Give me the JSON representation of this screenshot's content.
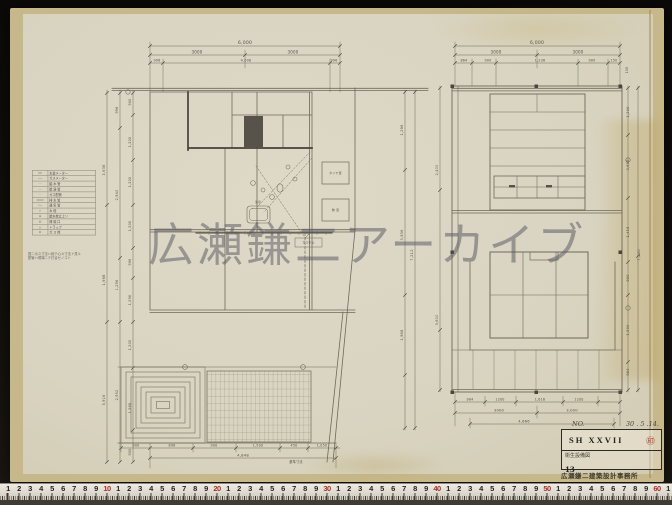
{
  "palette": {
    "backdrop": "#0e0d0a",
    "paper": "#d9d4c1",
    "paper_edge": "#c6b88a",
    "ink": "#6e6959",
    "ink_bold": "#45423a",
    "stamp_red": "#ae3226",
    "ruler_red": "#a93028",
    "watermark_gray": "#58585f"
  },
  "watermark": {
    "text": "広瀬鎌二アーカイブ"
  },
  "legend": {
    "rows": [
      {
        "sym": "━━",
        "label": "水道メーター"
      },
      {
        "sym": "──",
        "label": "ガスメーター"
      },
      {
        "sym": "‐ ‐",
        "label": "給 水 管"
      },
      {
        "sym": "-·-",
        "label": "給 湯 管"
      },
      {
        "sym": "····",
        "label": "ガス配管"
      },
      {
        "sym": "═══",
        "label": "排 水 管"
      },
      {
        "sym": "○─",
        "label": "通 気 管"
      },
      {
        "sym": "◇",
        "label": "水  栓"
      },
      {
        "sym": "●",
        "label": "給水栓立上リ"
      },
      {
        "sym": "◎",
        "label": "掃 除 口"
      },
      {
        "sym": "△",
        "label": "トラップ"
      },
      {
        "sym": "⊙",
        "label": "ガ ス 栓"
      }
    ]
  },
  "note": {
    "line1": "図ニ示ス寸法ハ総テ心々寸法ト見ル",
    "line2": "配管ハ現場ニテ打合セノコト"
  },
  "title_block": {
    "no_label": "NO.",
    "date": "30 . 5 .14.",
    "code": "SH XXVII",
    "stamp": "㊞",
    "subtitle": "衛生設備図",
    "sheet_no": "13",
    "office": "広瀬鎌二建築設計事務所"
  },
  "ruler": {
    "start_x": 8,
    "step": 11,
    "labels": [
      "1",
      "2",
      "3",
      "4",
      "5",
      "6",
      "7",
      "8",
      "9",
      "10",
      "1",
      "2",
      "3",
      "4",
      "5",
      "6",
      "7",
      "8",
      "9",
      "20",
      "1",
      "2",
      "3",
      "4",
      "5",
      "6",
      "7",
      "8",
      "9",
      "30",
      "1",
      "2",
      "3",
      "4",
      "5",
      "6",
      "7",
      "8",
      "9",
      "40",
      "1",
      "2",
      "3",
      "4",
      "5",
      "6",
      "7",
      "8",
      "9",
      "50",
      "1",
      "2",
      "3",
      "4",
      "5",
      "6",
      "7",
      "8",
      "9",
      "60",
      "1"
    ]
  },
  "drawing_labels": [
    {
      "t": "6,000",
      "x": 245,
      "y": 44
    },
    {
      "t": "3000",
      "x": 197,
      "y": 53.5,
      "s": 4
    },
    {
      "t": "3000",
      "x": 293,
      "y": 53.5,
      "s": 4
    },
    {
      "t": "996",
      "x": 157,
      "y": 61.5,
      "s": 3.4
    },
    {
      "t": "4,008",
      "x": 246,
      "y": 61.5,
      "s": 3.4
    },
    {
      "t": "996",
      "x": 334,
      "y": 61.5,
      "s": 3.4
    },
    {
      "t": "3,936",
      "x": 105,
      "y": 170,
      "r": -90,
      "s": 3.6
    },
    {
      "t": "1,968",
      "x": 105,
      "y": 280,
      "r": -90,
      "s": 3.6
    },
    {
      "t": "5,916",
      "x": 105,
      "y": 400,
      "r": -90,
      "s": 3.4
    },
    {
      "t": "996",
      "x": 118,
      "y": 110,
      "r": -90,
      "s": 3.4
    },
    {
      "t": "2,940",
      "x": 118,
      "y": 195,
      "r": -90,
      "s": 3.4
    },
    {
      "t": "1,296",
      "x": 118,
      "y": 285,
      "r": -90,
      "s": 3.4
    },
    {
      "t": "2,952",
      "x": 118,
      "y": 395,
      "r": -90,
      "s": 3.4
    },
    {
      "t": "900",
      "x": 131,
      "y": 102,
      "r": -90,
      "s": 3.3
    },
    {
      "t": "1,200",
      "x": 131,
      "y": 142,
      "r": -90,
      "s": 3.3
    },
    {
      "t": "1,200",
      "x": 131,
      "y": 182,
      "r": -90,
      "s": 3.3
    },
    {
      "t": "1,500",
      "x": 131,
      "y": 226,
      "r": -90,
      "s": 3.3
    },
    {
      "t": "996",
      "x": 131,
      "y": 262,
      "r": -90,
      "s": 3.3
    },
    {
      "t": "1,296",
      "x": 131,
      "y": 300,
      "r": -90,
      "s": 3.3
    },
    {
      "t": "1,200",
      "x": 131,
      "y": 345,
      "r": -90,
      "s": 3.3
    },
    {
      "t": "1,968",
      "x": 131,
      "y": 408,
      "r": -90,
      "s": 3.3
    },
    {
      "t": "900",
      "x": 131,
      "y": 452,
      "r": -90,
      "s": 3.3
    },
    {
      "t": "900",
      "x": 136,
      "y": 446.5,
      "s": 3.3
    },
    {
      "t": "898",
      "x": 172,
      "y": 446.5,
      "s": 3.3
    },
    {
      "t": "900",
      "x": 214,
      "y": 446.5,
      "s": 3.3
    },
    {
      "t": "1,500",
      "x": 258,
      "y": 446.5,
      "s": 3.3
    },
    {
      "t": "450",
      "x": 294,
      "y": 446.5,
      "s": 3.3
    },
    {
      "t": "1,050",
      "x": 322,
      "y": 446.5,
      "s": 3.3
    },
    {
      "t": "4,848",
      "x": 243,
      "y": 456.5,
      "s": 3.8
    },
    {
      "t": "基準寸法",
      "x": 296,
      "y": 463,
      "s": 3.2
    },
    {
      "t": "1,296",
      "x": 403,
      "y": 130,
      "r": -90,
      "s": 3.5
    },
    {
      "t": "3,936",
      "x": 403,
      "y": 235,
      "r": -90,
      "s": 3.5
    },
    {
      "t": "1,968",
      "x": 403,
      "y": 335,
      "r": -90,
      "s": 3.5
    },
    {
      "t": "7,212",
      "x": 413,
      "y": 255,
      "r": -90,
      "s": 3.7
    },
    {
      "t": "タイヤ置",
      "x": 335.5,
      "y": 174,
      "s": 3
    },
    {
      "t": "物 置",
      "x": 335.5,
      "y": 211,
      "s": 3
    },
    {
      "t": "浴室",
      "x": 258,
      "y": 203,
      "s": 2.8
    },
    {
      "t": "ガス引込",
      "x": 308.5,
      "y": 243.5,
      "s": 2.8
    },
    {
      "t": "6,000",
      "x": 537,
      "y": 44
    },
    {
      "t": "3000",
      "x": 496,
      "y": 53.5,
      "s": 4
    },
    {
      "t": "3000",
      "x": 578,
      "y": 53.5,
      "s": 4
    },
    {
      "t": "864",
      "x": 464,
      "y": 61.5,
      "s": 3.4
    },
    {
      "t": "900",
      "x": 488,
      "y": 61.5,
      "s": 3.4
    },
    {
      "t": "1,236",
      "x": 540,
      "y": 61.5,
      "s": 3.4
    },
    {
      "t": "900",
      "x": 592,
      "y": 61.5,
      "s": 3.4
    },
    {
      "t": "150",
      "x": 614,
      "y": 61.5,
      "s": 3.2
    },
    {
      "t": "150",
      "x": 628,
      "y": 70,
      "r": -90,
      "s": 3.2
    },
    {
      "t": "984",
      "x": 470,
      "y": 400.5,
      "s": 3.3
    },
    {
      "t": "1200",
      "x": 500,
      "y": 400.5,
      "s": 3.3
    },
    {
      "t": "1,616",
      "x": 540,
      "y": 400.5,
      "s": 3.3
    },
    {
      "t": "1200",
      "x": 579,
      "y": 400.5,
      "s": 3.3
    },
    {
      "t": "3000",
      "x": 499,
      "y": 411.5,
      "s": 3.7
    },
    {
      "t": "3,000",
      "x": 572,
      "y": 411.5,
      "s": 3.7
    },
    {
      "t": "4,666",
      "x": 524,
      "y": 422.5,
      "s": 3.7
    },
    {
      "t": "1,200",
      "x": 629,
      "y": 112,
      "r": -90,
      "s": 3.5
    },
    {
      "t": "3,600",
      "x": 629,
      "y": 165,
      "r": -90,
      "s": 3.5
    },
    {
      "t": "1,416",
      "x": 629,
      "y": 232,
      "r": -90,
      "s": 3.5
    },
    {
      "t": "900",
      "x": 629,
      "y": 278,
      "r": -90,
      "s": 3.5
    },
    {
      "t": "1,500",
      "x": 629,
      "y": 330,
      "r": -90,
      "s": 3.5
    },
    {
      "t": "984",
      "x": 629,
      "y": 372,
      "r": -90,
      "s": 3.5
    },
    {
      "t": "7,200",
      "x": 640,
      "y": 255,
      "r": -90,
      "s": 3.7
    },
    {
      "t": "2,400",
      "x": 438,
      "y": 170,
      "r": -90,
      "s": 3.4
    },
    {
      "t": "3,600",
      "x": 438,
      "y": 320,
      "r": -90,
      "s": 3.4
    }
  ]
}
